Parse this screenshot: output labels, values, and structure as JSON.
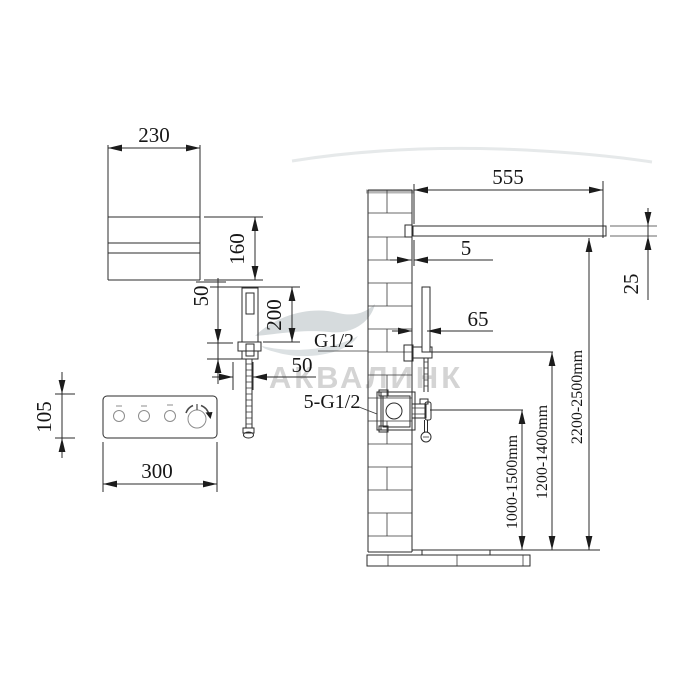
{
  "drawing": {
    "watermark": {
      "brand": "АКВАЛИНК"
    },
    "overhead_spout_view": {
      "width": "230",
      "depth": "160"
    },
    "hand_shower_view": {
      "holder_height": "50",
      "length": "200",
      "connector_width": "50"
    },
    "control_panel_view": {
      "height": "105",
      "width": "300"
    },
    "installation_view": {
      "spout_length": "555",
      "wall_gap": "5",
      "spout_thickness": "25",
      "hand_shower_offset": "65",
      "hand_shower_thread": "G1/2",
      "valve_thread": "5-G1/2",
      "valve_height_range": "1000-1500mm",
      "hand_shower_height_range": "1200-1400mm",
      "spout_height_range": "2200-2500mm"
    }
  },
  "colors": {
    "line": "#2b2b2b",
    "watermark": "#d4d4d4",
    "wall_cap": "#b5b5b5"
  }
}
